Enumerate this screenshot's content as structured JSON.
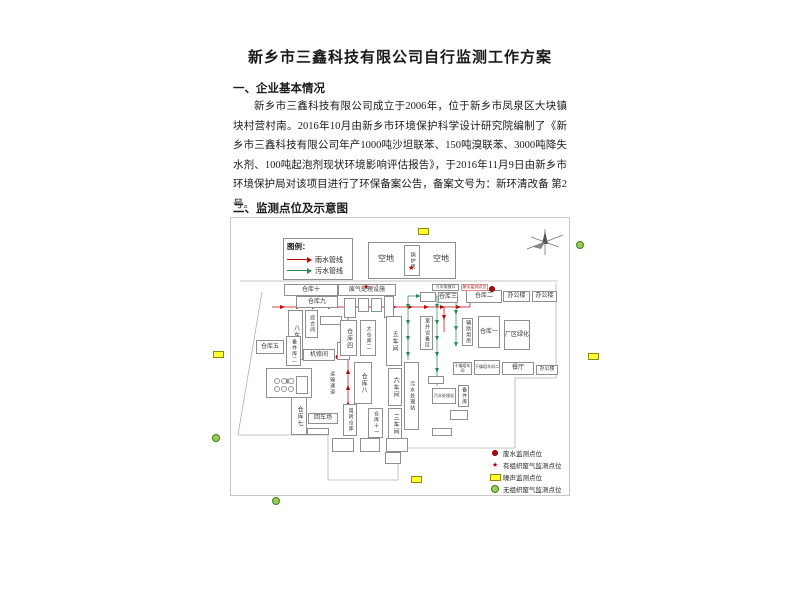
{
  "doc": {
    "title": "新乡市三鑫科技有限公司自行监测工作方案",
    "section1": "一、企业基本情况",
    "paragraph": "新乡市三鑫科技有限公司成立于2006年，位于新乡市凤泉区大块镇块村营村南。2016年10月由新乡市环境保护科学设计研究院编制了《新乡市三鑫科技有限公司年产1000吨沙坦联苯、150吨溴联苯、3000吨降失水剂、100吨起泡剂现状环境影响评估报告》，于2016年11月9日由新乡市环境保护局对该项目进行了环保备案公告，备案文号为：新环清改备 第2号。",
    "section2": "二、监测点位及示意图"
  },
  "pipe_legend": {
    "title": "图例：",
    "items": [
      {
        "label": "雨水管线",
        "color": "#c00000"
      },
      {
        "label": "污水管线",
        "color": "#2e8b57"
      }
    ]
  },
  "point_legend": {
    "items": [
      {
        "marker": "waste",
        "label": "废水监测点位"
      },
      {
        "marker": "stack",
        "label": "有组织废气监测点位"
      },
      {
        "marker": "noise",
        "label": "噪声监测点位"
      },
      {
        "marker": "fug",
        "label": "无组织废气监测点位"
      }
    ]
  },
  "colors": {
    "rain": "#c00000",
    "sewage": "#2e8b57",
    "boundary": "#b0b0b0",
    "noise": "#ffff33",
    "fugitive": "#9ccc55",
    "waste": "#c00000"
  },
  "figure": {
    "buildings": [
      {
        "label": "",
        "x": 368,
        "y": 242,
        "w": 88,
        "h": 37,
        "fs": 6
      },
      {
        "label": "空地",
        "x": 371,
        "y": 252,
        "w": 30,
        "h": 14,
        "fs": 8,
        "nb": true
      },
      {
        "label": "空地",
        "x": 428,
        "y": 252,
        "w": 26,
        "h": 14,
        "fs": 8,
        "nb": true
      },
      {
        "label": "锅炉房",
        "x": 404,
        "y": 245,
        "w": 16,
        "h": 31,
        "fs": 5,
        "v": true
      },
      {
        "label": "仓库十",
        "x": 284,
        "y": 284,
        "w": 54,
        "h": 12,
        "fs": 6
      },
      {
        "label": "仓库九",
        "x": 296,
        "y": 296,
        "w": 42,
        "h": 12,
        "fs": 6
      },
      {
        "label": "废气处理设施",
        "x": 338,
        "y": 284,
        "w": 58,
        "h": 12,
        "fs": 6
      },
      {
        "label": "",
        "x": 344,
        "y": 298,
        "w": 12,
        "h": 20,
        "fs": 4
      },
      {
        "label": "",
        "x": 358,
        "y": 298,
        "w": 11,
        "h": 14,
        "fs": 4
      },
      {
        "label": "",
        "x": 371,
        "y": 298,
        "w": 11,
        "h": 14,
        "fs": 4
      },
      {
        "label": "",
        "x": 384,
        "y": 296,
        "w": 10,
        "h": 22,
        "fs": 4
      },
      {
        "label": "八车间",
        "x": 288,
        "y": 310,
        "w": 15,
        "h": 50,
        "fs": 6,
        "v": true
      },
      {
        "label": "综合间",
        "x": 305,
        "y": 310,
        "w": 13,
        "h": 28,
        "fs": 5,
        "v": true
      },
      {
        "label": "",
        "x": 320,
        "y": 316,
        "w": 22,
        "h": 9,
        "fs": 4
      },
      {
        "label": "仓库五",
        "x": 256,
        "y": 340,
        "w": 28,
        "h": 14,
        "fs": 6
      },
      {
        "label": "备件库二",
        "x": 286,
        "y": 336,
        "w": 15,
        "h": 30,
        "fs": 5,
        "v": true
      },
      {
        "label": "机修间",
        "x": 303,
        "y": 349,
        "w": 32,
        "h": 12,
        "fs": 6
      },
      {
        "label": "",
        "x": 337,
        "y": 342,
        "w": 13,
        "h": 18,
        "fs": 4
      },
      {
        "label": "仓库四",
        "x": 340,
        "y": 320,
        "w": 17,
        "h": 36,
        "fs": 6,
        "v": true
      },
      {
        "label": "大仓库二",
        "x": 360,
        "y": 320,
        "w": 16,
        "h": 36,
        "fs": 5,
        "v": true
      },
      {
        "label": "五车间",
        "x": 386,
        "y": 316,
        "w": 16,
        "h": 50,
        "fs": 6,
        "v": true
      },
      {
        "label": "室外设备区",
        "x": 420,
        "y": 316,
        "w": 13,
        "h": 34,
        "fs": 5,
        "v": true
      },
      {
        "label": "辅助用房",
        "x": 462,
        "y": 318,
        "w": 11,
        "h": 28,
        "fs": 5,
        "v": true
      },
      {
        "label": "仓库一",
        "x": 478,
        "y": 316,
        "w": 22,
        "h": 32,
        "fs": 6
      },
      {
        "label": "厂区绿化",
        "x": 504,
        "y": 320,
        "w": 26,
        "h": 30,
        "fs": 6
      },
      {
        "label": "",
        "x": 420,
        "y": 292,
        "w": 16,
        "h": 10,
        "fs": 4
      },
      {
        "label": "仓库三",
        "x": 438,
        "y": 292,
        "w": 20,
        "h": 11,
        "fs": 6
      },
      {
        "label": "仓库二",
        "x": 466,
        "y": 290,
        "w": 36,
        "h": 13,
        "fs": 6
      },
      {
        "label": "办公楼",
        "x": 503,
        "y": 291,
        "w": 27,
        "h": 11,
        "fs": 6
      },
      {
        "label": "办公楼",
        "x": 532,
        "y": 291,
        "w": 25,
        "h": 11,
        "fs": 6
      },
      {
        "label": "污水排放口",
        "x": 432,
        "y": 284,
        "w": 27,
        "h": 7,
        "fs": 4
      },
      {
        "label": "废水监测点位",
        "x": 461,
        "y": 284,
        "w": 27,
        "h": 7,
        "fs": 4,
        "red": true
      },
      {
        "label": "罐区",
        "x": 266,
        "y": 368,
        "w": 46,
        "h": 30,
        "fs": 5
      },
      {
        "label": "运输通道",
        "x": 327,
        "y": 364,
        "w": 9,
        "h": 38,
        "fs": 5,
        "v": true,
        "nb": true
      },
      {
        "label": "仓库八",
        "x": 354,
        "y": 362,
        "w": 18,
        "h": 42,
        "fs": 6,
        "v": true
      },
      {
        "label": "六车间",
        "x": 388,
        "y": 368,
        "w": 14,
        "h": 38,
        "fs": 6,
        "v": true
      },
      {
        "label": "污水处理站",
        "x": 404,
        "y": 362,
        "w": 15,
        "h": 68,
        "fs": 5,
        "v": true
      },
      {
        "label": "三车间",
        "x": 388,
        "y": 408,
        "w": 14,
        "h": 32,
        "fs": 6,
        "v": true
      },
      {
        "label": "仓库七",
        "x": 291,
        "y": 397,
        "w": 16,
        "h": 38,
        "fs": 6,
        "v": true
      },
      {
        "label": "回车场",
        "x": 308,
        "y": 413,
        "w": 30,
        "h": 11,
        "fs": 6
      },
      {
        "label": "周转仓库",
        "x": 343,
        "y": 404,
        "w": 14,
        "h": 32,
        "fs": 5,
        "v": true
      },
      {
        "label": "仓库十一",
        "x": 368,
        "y": 408,
        "w": 15,
        "h": 30,
        "fs": 5,
        "v": true
      },
      {
        "label": "干燥塔车间",
        "x": 453,
        "y": 362,
        "w": 19,
        "h": 13,
        "fs": 4
      },
      {
        "label": "干燥塔车间二",
        "x": 474,
        "y": 360,
        "w": 26,
        "h": 15,
        "fs": 4
      },
      {
        "label": "餐厅",
        "x": 502,
        "y": 362,
        "w": 32,
        "h": 13,
        "fs": 6
      },
      {
        "label": "办公楼",
        "x": 536,
        "y": 365,
        "w": 22,
        "h": 10,
        "fs": 5
      },
      {
        "label": "污水处理站",
        "x": 432,
        "y": 388,
        "w": 24,
        "h": 16,
        "fs": 4
      },
      {
        "label": "备件库",
        "x": 458,
        "y": 385,
        "w": 11,
        "h": 22,
        "fs": 5,
        "v": true
      },
      {
        "label": "",
        "x": 428,
        "y": 376,
        "w": 16,
        "h": 8,
        "fs": 4
      },
      {
        "label": "",
        "x": 450,
        "y": 410,
        "w": 18,
        "h": 10,
        "fs": 4
      },
      {
        "label": "",
        "x": 432,
        "y": 428,
        "w": 20,
        "h": 8,
        "fs": 4
      },
      {
        "label": "",
        "x": 332,
        "y": 438,
        "w": 22,
        "h": 14,
        "fs": 4
      },
      {
        "label": "",
        "x": 360,
        "y": 438,
        "w": 20,
        "h": 14,
        "fs": 4
      },
      {
        "label": "",
        "x": 386,
        "y": 438,
        "w": 22,
        "h": 14,
        "fs": 4
      },
      {
        "label": "",
        "x": 307,
        "y": 428,
        "w": 22,
        "h": 7,
        "fs": 4
      },
      {
        "label": "",
        "x": 385,
        "y": 452,
        "w": 16,
        "h": 12,
        "fs": 4
      },
      {
        "label": "",
        "x": 296,
        "y": 376,
        "w": 12,
        "h": 18,
        "fs": 4
      }
    ],
    "boundary_lines": [
      {
        "x1": 240,
        "y1": 281,
        "x2": 558,
        "y2": 281
      },
      {
        "x1": 262,
        "y1": 292,
        "x2": 238,
        "y2": 435
      },
      {
        "x1": 238,
        "y1": 435,
        "x2": 328,
        "y2": 435
      },
      {
        "x1": 328,
        "y1": 435,
        "x2": 328,
        "y2": 480
      },
      {
        "x1": 328,
        "y1": 480,
        "x2": 398,
        "y2": 480
      },
      {
        "x1": 398,
        "y1": 480,
        "x2": 398,
        "y2": 448
      },
      {
        "x1": 398,
        "y1": 448,
        "x2": 515,
        "y2": 448
      },
      {
        "x1": 515,
        "y1": 448,
        "x2": 515,
        "y2": 378
      },
      {
        "x1": 515,
        "y1": 378,
        "x2": 556,
        "y2": 378
      },
      {
        "x1": 556,
        "y1": 378,
        "x2": 556,
        "y2": 283
      }
    ],
    "pipes": [
      {
        "c": "#c00000",
        "x1": 272,
        "y1": 307,
        "x2": 470,
        "y2": 307
      },
      {
        "c": "#c00000",
        "x1": 470,
        "y1": 307,
        "x2": 470,
        "y2": 292
      },
      {
        "c": "#c00000",
        "x1": 348,
        "y1": 430,
        "x2": 348,
        "y2": 308
      },
      {
        "c": "#c00000",
        "x1": 296,
        "y1": 357,
        "x2": 348,
        "y2": 357
      },
      {
        "c": "#c00000",
        "x1": 444,
        "y1": 307,
        "x2": 444,
        "y2": 332
      },
      {
        "c": "#2e8b57",
        "x1": 408,
        "y1": 296,
        "x2": 408,
        "y2": 360
      },
      {
        "c": "#2e8b57",
        "x1": 408,
        "y1": 296,
        "x2": 437,
        "y2": 296
      },
      {
        "c": "#2e8b57",
        "x1": 437,
        "y1": 296,
        "x2": 437,
        "y2": 386
      },
      {
        "c": "#2e8b57",
        "x1": 456,
        "y1": 302,
        "x2": 456,
        "y2": 345
      }
    ],
    "markers": [
      {
        "type": "noise",
        "x": 418,
        "y": 228
      },
      {
        "type": "noise",
        "x": 213,
        "y": 351
      },
      {
        "type": "noise",
        "x": 588,
        "y": 353
      },
      {
        "type": "noise",
        "x": 411,
        "y": 476
      },
      {
        "type": "fug",
        "x": 576,
        "y": 241
      },
      {
        "type": "fug",
        "x": 212,
        "y": 434
      },
      {
        "type": "fug",
        "x": 272,
        "y": 497
      },
      {
        "type": "waste",
        "x": 489,
        "y": 286
      },
      {
        "type": "stack",
        "x": 408,
        "y": 265
      },
      {
        "type": "stack",
        "x": 363,
        "y": 284
      },
      {
        "type": "tank",
        "x": 274,
        "y": 378
      },
      {
        "type": "tank",
        "x": 281,
        "y": 378
      },
      {
        "type": "tank",
        "x": 288,
        "y": 378
      },
      {
        "type": "tank",
        "x": 274,
        "y": 386
      },
      {
        "type": "tank",
        "x": 281,
        "y": 386
      },
      {
        "type": "tank",
        "x": 288,
        "y": 386
      }
    ],
    "compass": {
      "x": 527,
      "y": 227
    }
  }
}
